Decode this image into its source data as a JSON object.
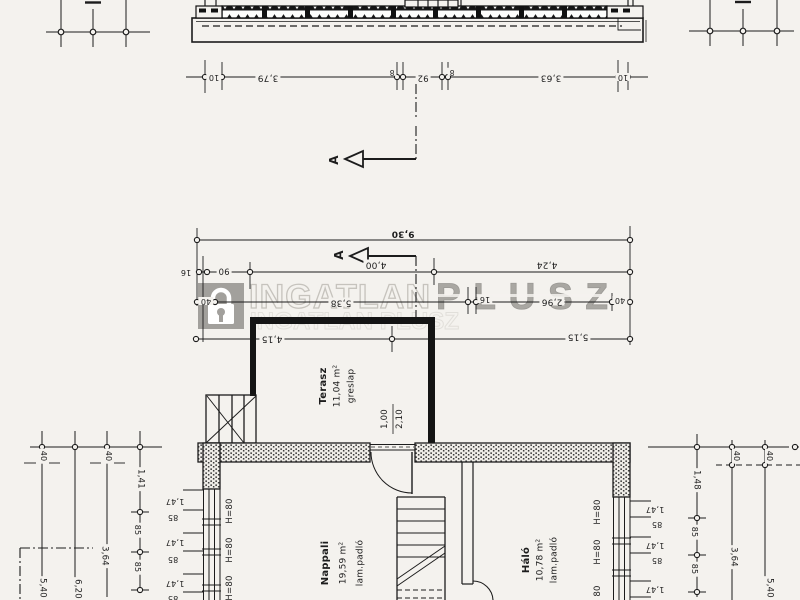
{
  "watermark": {
    "brand_left": "INGATLAN",
    "brand_right": "PLUSZ",
    "ghost_text": "INGATLAN PLUSZ",
    "lock_icon": "lock"
  },
  "section_top": {
    "dims": [
      "10",
      "3,79",
      "8",
      "92",
      "8",
      "3,63",
      "10"
    ]
  },
  "section_marker_label": "A",
  "plan": {
    "dim_total": "9,30",
    "dim_row2": [
      "16",
      "90",
      "4,00",
      "4,24"
    ],
    "dim_row3": [
      "40",
      "5,38",
      "16",
      "2,96",
      "40"
    ],
    "dim_row4": [
      "4,15",
      "5,15"
    ],
    "door": {
      "width": "1,00",
      "height": "2,10"
    },
    "rooms": [
      {
        "name": "Terasz",
        "area": "11,04 m²",
        "floor": "greslap"
      },
      {
        "name": "Nappali",
        "area": "19,59 m²",
        "floor": "lam.padló"
      },
      {
        "name": "Háló",
        "area": "10,78 m²",
        "floor": "lam.padló"
      }
    ],
    "win_h_left": [
      "H=80",
      "H=80",
      "H=80"
    ],
    "win_h_right": [
      "H=80",
      "H=80",
      "80"
    ],
    "win_dims_left": [
      "1,47",
      "85",
      "1,47",
      "85",
      "1,47",
      "85"
    ],
    "win_dims_right": [
      "1,47",
      "85",
      "1,47",
      "85",
      "1,47"
    ],
    "col_dims_left": [
      "40",
      "5,40",
      "6,20",
      "40",
      "3,64",
      "1,41",
      "85",
      "85"
    ],
    "col_dims_right": [
      "1,48",
      "85",
      "85",
      "40",
      "3,64",
      "40",
      "5,40"
    ]
  }
}
